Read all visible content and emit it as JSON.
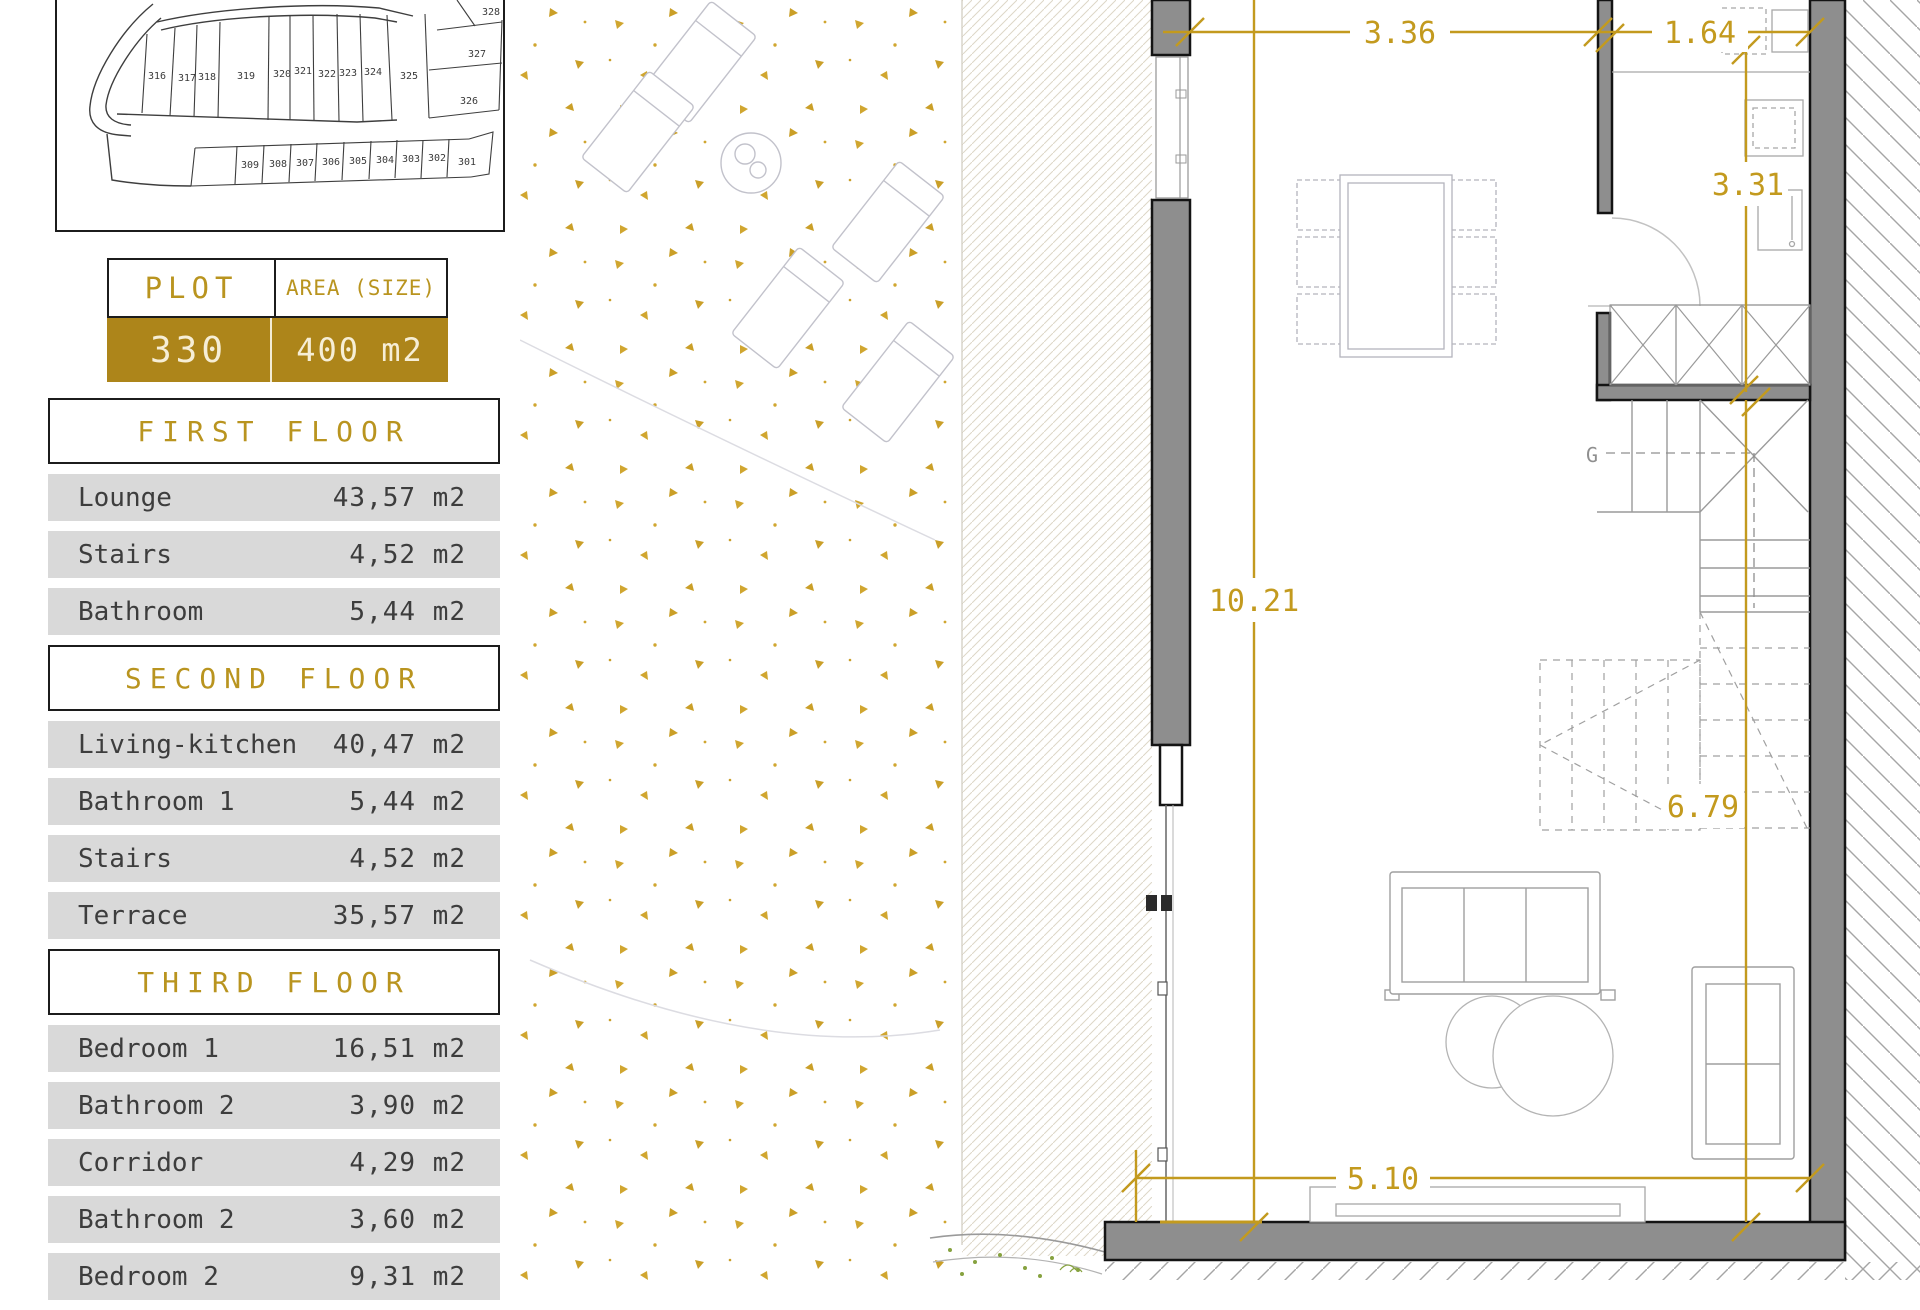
{
  "site_plan": {
    "labels": [
      "316",
      "317",
      "318",
      "319",
      "320",
      "321",
      "322",
      "323",
      "324",
      "325",
      "326",
      "327",
      "328",
      "309",
      "308",
      "307",
      "306",
      "305",
      "304",
      "303",
      "302",
      "301"
    ]
  },
  "plot_table": {
    "col1_header": "PLOT",
    "col2_header": "AREA (SIZE)",
    "plot_number": "330",
    "area_value": "400 m2"
  },
  "floors": [
    {
      "title": "FIRST FLOOR",
      "rows": [
        {
          "label": "Lounge",
          "value": "43,57 m2"
        },
        {
          "label": "Stairs",
          "value": "4,52 m2"
        },
        {
          "label": "Bathroom",
          "value": "5,44 m2"
        }
      ]
    },
    {
      "title": "SECOND FLOOR",
      "rows": [
        {
          "label": "Living-kitchen",
          "value": "40,47 m2"
        },
        {
          "label": "Bathroom 1",
          "value": "5,44 m2"
        },
        {
          "label": "Stairs",
          "value": "4,52 m2"
        },
        {
          "label": "Terrace",
          "value": "35,57 m2"
        }
      ]
    },
    {
      "title": "THIRD FLOOR",
      "rows": [
        {
          "label": "Bedroom 1",
          "value": "16,51 m2"
        },
        {
          "label": "Bathroom 2",
          "value": "3,90 m2"
        },
        {
          "label": "Corridor",
          "value": "4,29 m2"
        },
        {
          "label": "Bathroom 2",
          "value": "3,60 m2"
        },
        {
          "label": "Bedroom 2",
          "value": "9,31 m2"
        }
      ]
    }
  ],
  "floor_plan": {
    "dimensions": {
      "width_a": "3.36",
      "width_b": "1.64",
      "kitchen_depth": "3.31",
      "room_length": "10.21",
      "stair_zone": "6.79",
      "bottom_width": "5.10"
    },
    "stairs_direction_label": "G"
  },
  "colors": {
    "gold": "#c39a1e",
    "gold_dark": "#ad851a",
    "row_gray": "#d9d9d9",
    "wall_gray": "#8e8e8e",
    "line_black": "#141414"
  }
}
